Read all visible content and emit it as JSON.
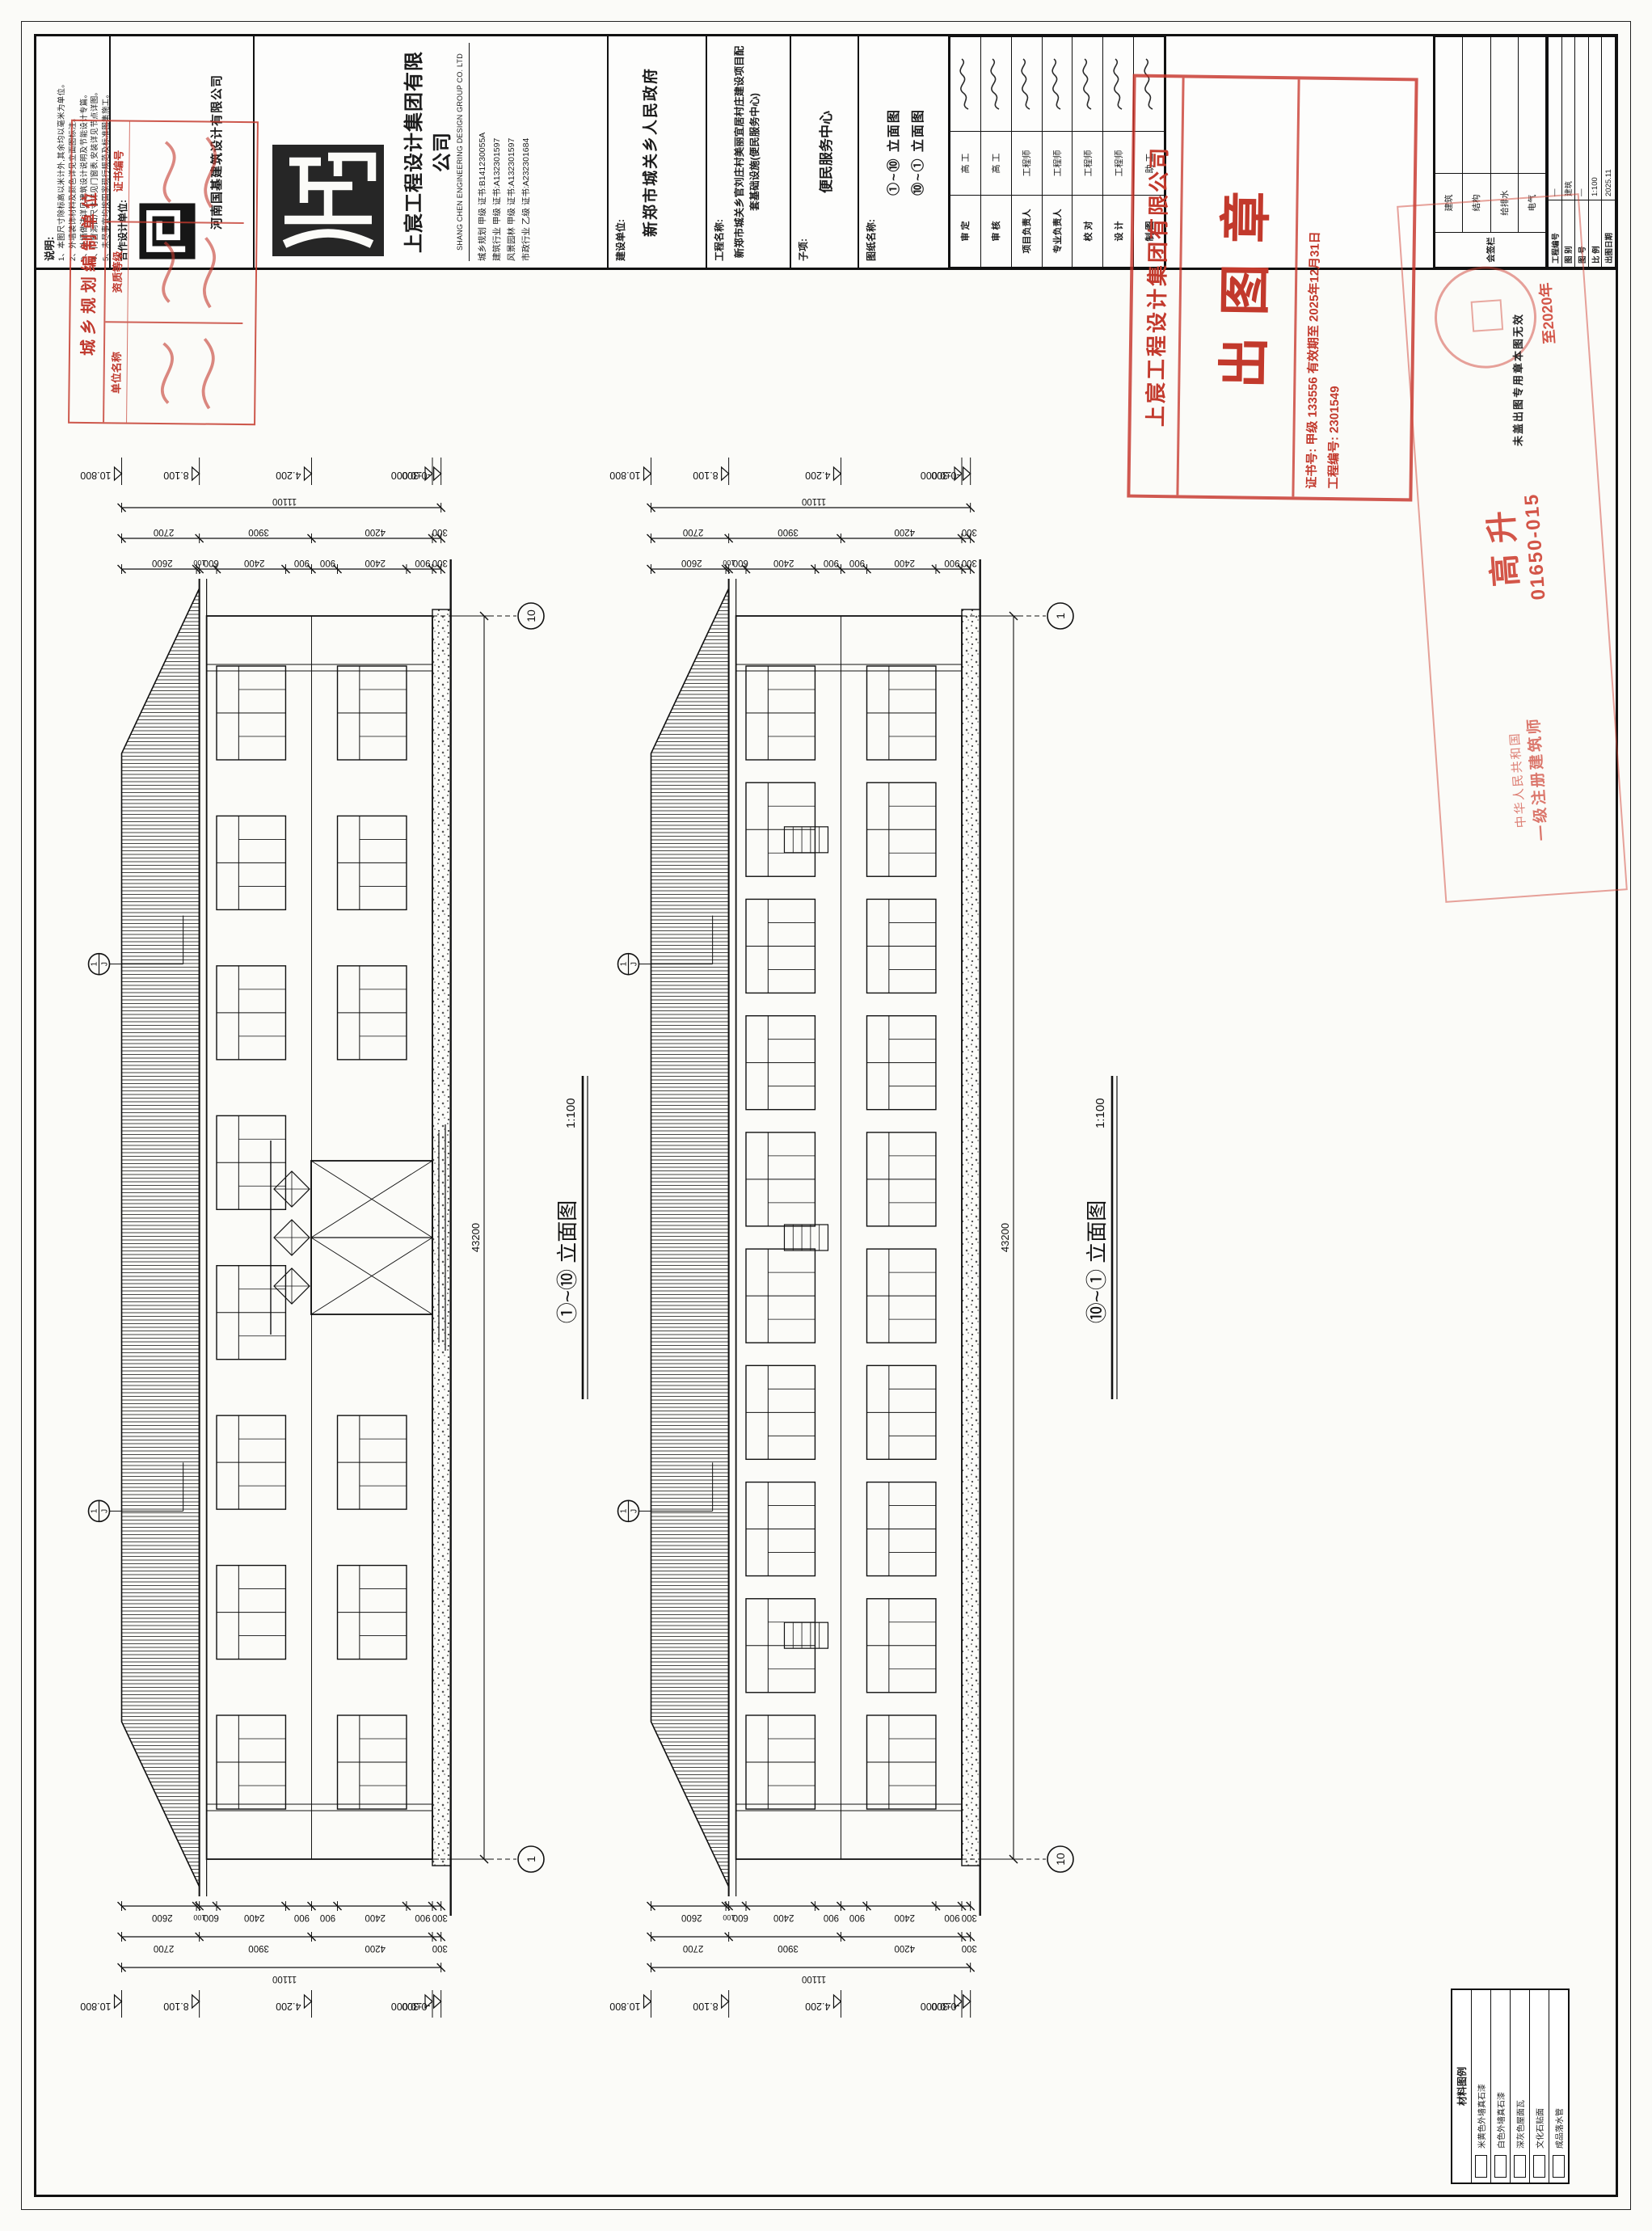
{
  "notes": {
    "title": "说明:",
    "items": [
      "1、本图尺寸除标高以米计外,其余均以毫米为单位。",
      "2、外墙装饰材料及颜色详见立面图标注。",
      "3、外墙做法详见建筑设计说明及节能设计专篇。",
      "4、门窗洞口尺寸详见门窗表,安装详见节点详图。",
      "5、未尽事宜均按国家现行规范及标准图集施工。"
    ]
  },
  "cooperate": {
    "label": "合作设计单位:",
    "firm": "河南国基建筑设计有限公司"
  },
  "company": {
    "name_cn": "上宸工程设计集团有限公司",
    "name_en": "SHANG CHEN ENGINEERING DESIGN GROUP CO. LTD",
    "certs": [
      "城乡规划 甲级 证书:B141230055A",
      "建筑行业 甲级 证书:A132301597",
      "风景园林 甲级 证书:A132301597",
      "市政行业 乙级 证书:A232301684"
    ]
  },
  "owner": {
    "label": "建设单位:",
    "value": "新郑市城关乡人民政府"
  },
  "project": {
    "label": "工程名称:",
    "value": "新郑市城关乡官刘庄村美丽宜居村庄建设项目配套基础设施(便民服务中心)"
  },
  "subproject": {
    "label": "子项:",
    "value": "便民服务中心"
  },
  "drawing_title": {
    "label": "图纸名称:",
    "lines": [
      "①~⑩ 立面图",
      "⑩~① 立面图"
    ]
  },
  "signatures": {
    "rows": [
      {
        "role": "审 定",
        "title": "高 工"
      },
      {
        "role": "审 核",
        "title": "高 工"
      },
      {
        "role": "项目负责人",
        "title": "工程师"
      },
      {
        "role": "专业负责人",
        "title": "工程师"
      },
      {
        "role": "校 对",
        "title": "工程师"
      },
      {
        "role": "设 计",
        "title": "工程师"
      },
      {
        "role": "制 图",
        "title": "助 工"
      }
    ]
  },
  "countersign": {
    "title": "会签栏",
    "rows": [
      "建筑",
      "结构",
      "给排水",
      "电气"
    ]
  },
  "info_table": {
    "rows": [
      [
        "工程编号",
        "—"
      ],
      [
        "图 别",
        "建筑"
      ],
      [
        "图 号",
        "—"
      ],
      [
        "比 例",
        "1:100"
      ],
      [
        "出图日期",
        "2025.11"
      ]
    ]
  },
  "stamps": {
    "planning": {
      "header": "城乡规划编制单位",
      "cols": [
        "单位名称",
        "资质等级",
        "证书编号"
      ]
    },
    "release": {
      "company": "上宸工程设计集团有限公司",
      "seal": "出图章",
      "cert_line": "证书号: 甲级 133556  有效期至 2025年12月31日",
      "proj_line": "工程编号: 2301549"
    },
    "architect": {
      "line1": "中华人民共和国",
      "line2": "一级注册建筑师",
      "name": "高 升",
      "number": "01650-015",
      "valid": "至2020年"
    },
    "invalid_note": "未盖出图专用章本图无效"
  },
  "legend": {
    "title": "材料图例",
    "rows": [
      "米黄色外墙真石漆",
      "白色外墙真石漆",
      "深灰色屋面瓦",
      "文化石贴面",
      "成品落水管"
    ]
  },
  "chart_data": {
    "type": "table",
    "title": "立面图尺寸数据 (elevation dimension data, mm)",
    "elevations": [
      {
        "label": "①~⑩ 立面图",
        "scale": "1:100",
        "axis_left": "1",
        "axis_right": "10",
        "overall_length": 43200,
        "levels": [
          {
            "text": "10.800",
            "mm": 10800
          },
          {
            "text": "8.100",
            "mm": 8100
          },
          {
            "text": "4.200",
            "mm": 4200
          },
          {
            "text": "±0.000",
            "mm": 0
          },
          {
            "text": "-0.300",
            "mm": -300
          }
        ],
        "dim_outer": [
          11100
        ],
        "dim_mid": [
          2700,
          3900,
          4200,
          300
        ],
        "dim_inner": [
          2600,
          100,
          600,
          2400,
          900,
          900,
          2400,
          900,
          300
        ],
        "bays": 8,
        "has_entrance": true,
        "has_louvres": false,
        "callout": {
          "top": "1",
          "bottom": "J"
        }
      },
      {
        "label": "⑩~① 立面图",
        "scale": "1:100",
        "axis_left": "10",
        "axis_right": "1",
        "overall_length": 43200,
        "levels": [
          {
            "text": "10.800",
            "mm": 10800
          },
          {
            "text": "8.100",
            "mm": 8100
          },
          {
            "text": "4.200",
            "mm": 4200
          },
          {
            "text": "±0.000",
            "mm": 0
          },
          {
            "text": "-0.300",
            "mm": -300
          }
        ],
        "dim_outer": [
          11100
        ],
        "dim_mid": [
          2700,
          3900,
          4200,
          300
        ],
        "dim_inner": [
          2600,
          100,
          600,
          2400,
          900,
          900,
          2400,
          900,
          300
        ],
        "bays": 10,
        "has_entrance": false,
        "has_louvres": true,
        "callout": {
          "top": "1",
          "bottom": "J"
        }
      }
    ]
  }
}
